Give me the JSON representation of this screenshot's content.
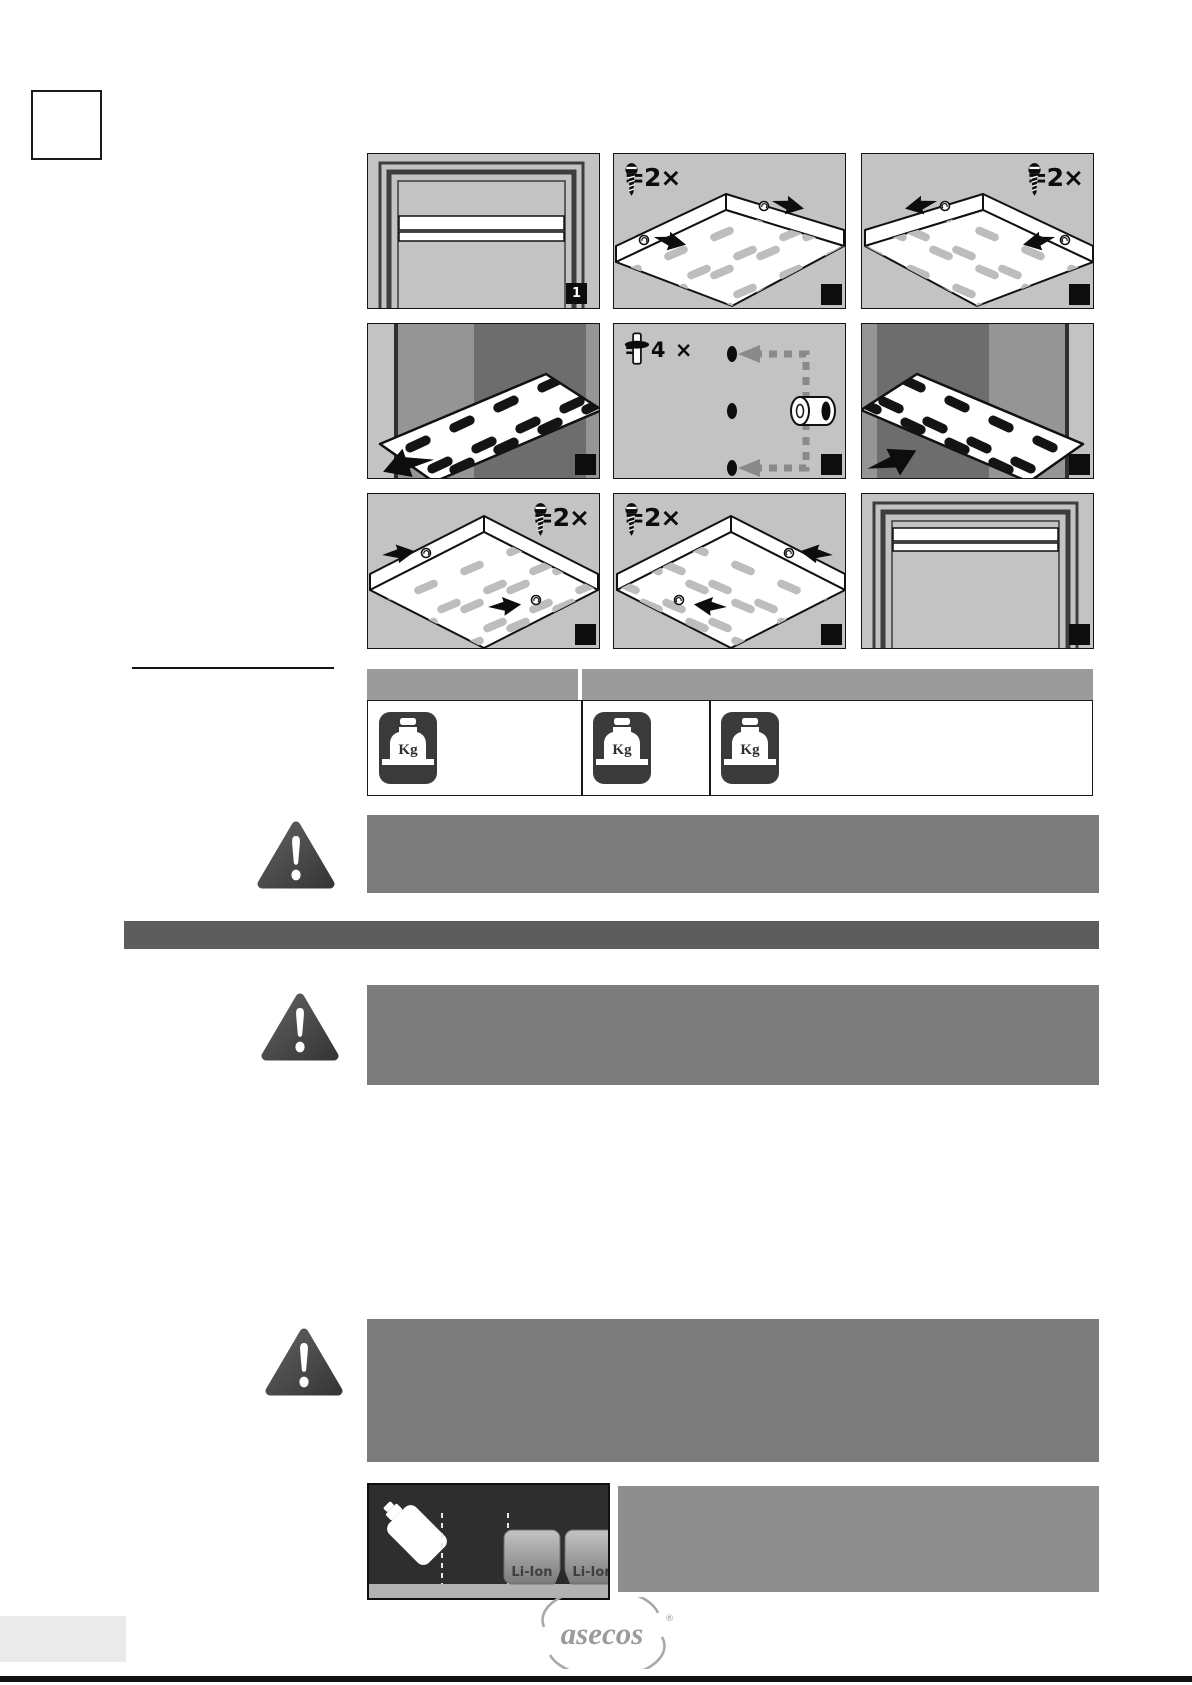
{
  "panels": [
    {
      "name": "cabinet-door-closed",
      "badge": "1"
    },
    {
      "name": "tray-unscrew-front-left",
      "screw_label": "=2×"
    },
    {
      "name": "tray-unscrew-front-right",
      "screw_label": "=2×"
    },
    {
      "name": "shelf-pull-out"
    },
    {
      "name": "shelf-plug-reposition",
      "plug_label": "= 4 ×"
    },
    {
      "name": "shelf-push-in"
    },
    {
      "name": "tray-screw-rear-left",
      "screw_label": "=2×"
    },
    {
      "name": "tray-screw-rear-right",
      "screw_label": "=2×"
    },
    {
      "name": "cabinet-shelf-installed"
    }
  ],
  "load_table": {
    "kg_labels": [
      "Kg",
      "Kg",
      "Kg"
    ]
  },
  "bottom_figure": {
    "battery_labels": [
      "Li-Ion",
      "Li-Ion"
    ]
  },
  "footer": {
    "brand": "asecos",
    "registered_mark": "®"
  },
  "colors": {
    "panel_bg": "#c3c3c3",
    "table_header_gray": "#9b9b9b",
    "warning_bar_gray": "#7c7c7c",
    "section_bar_gray": "#5d5d5d",
    "figure_side_bar_gray": "#8e8e8e",
    "figure_bg": "#2e2e2e",
    "logo_gray": "#9b9b9b"
  }
}
